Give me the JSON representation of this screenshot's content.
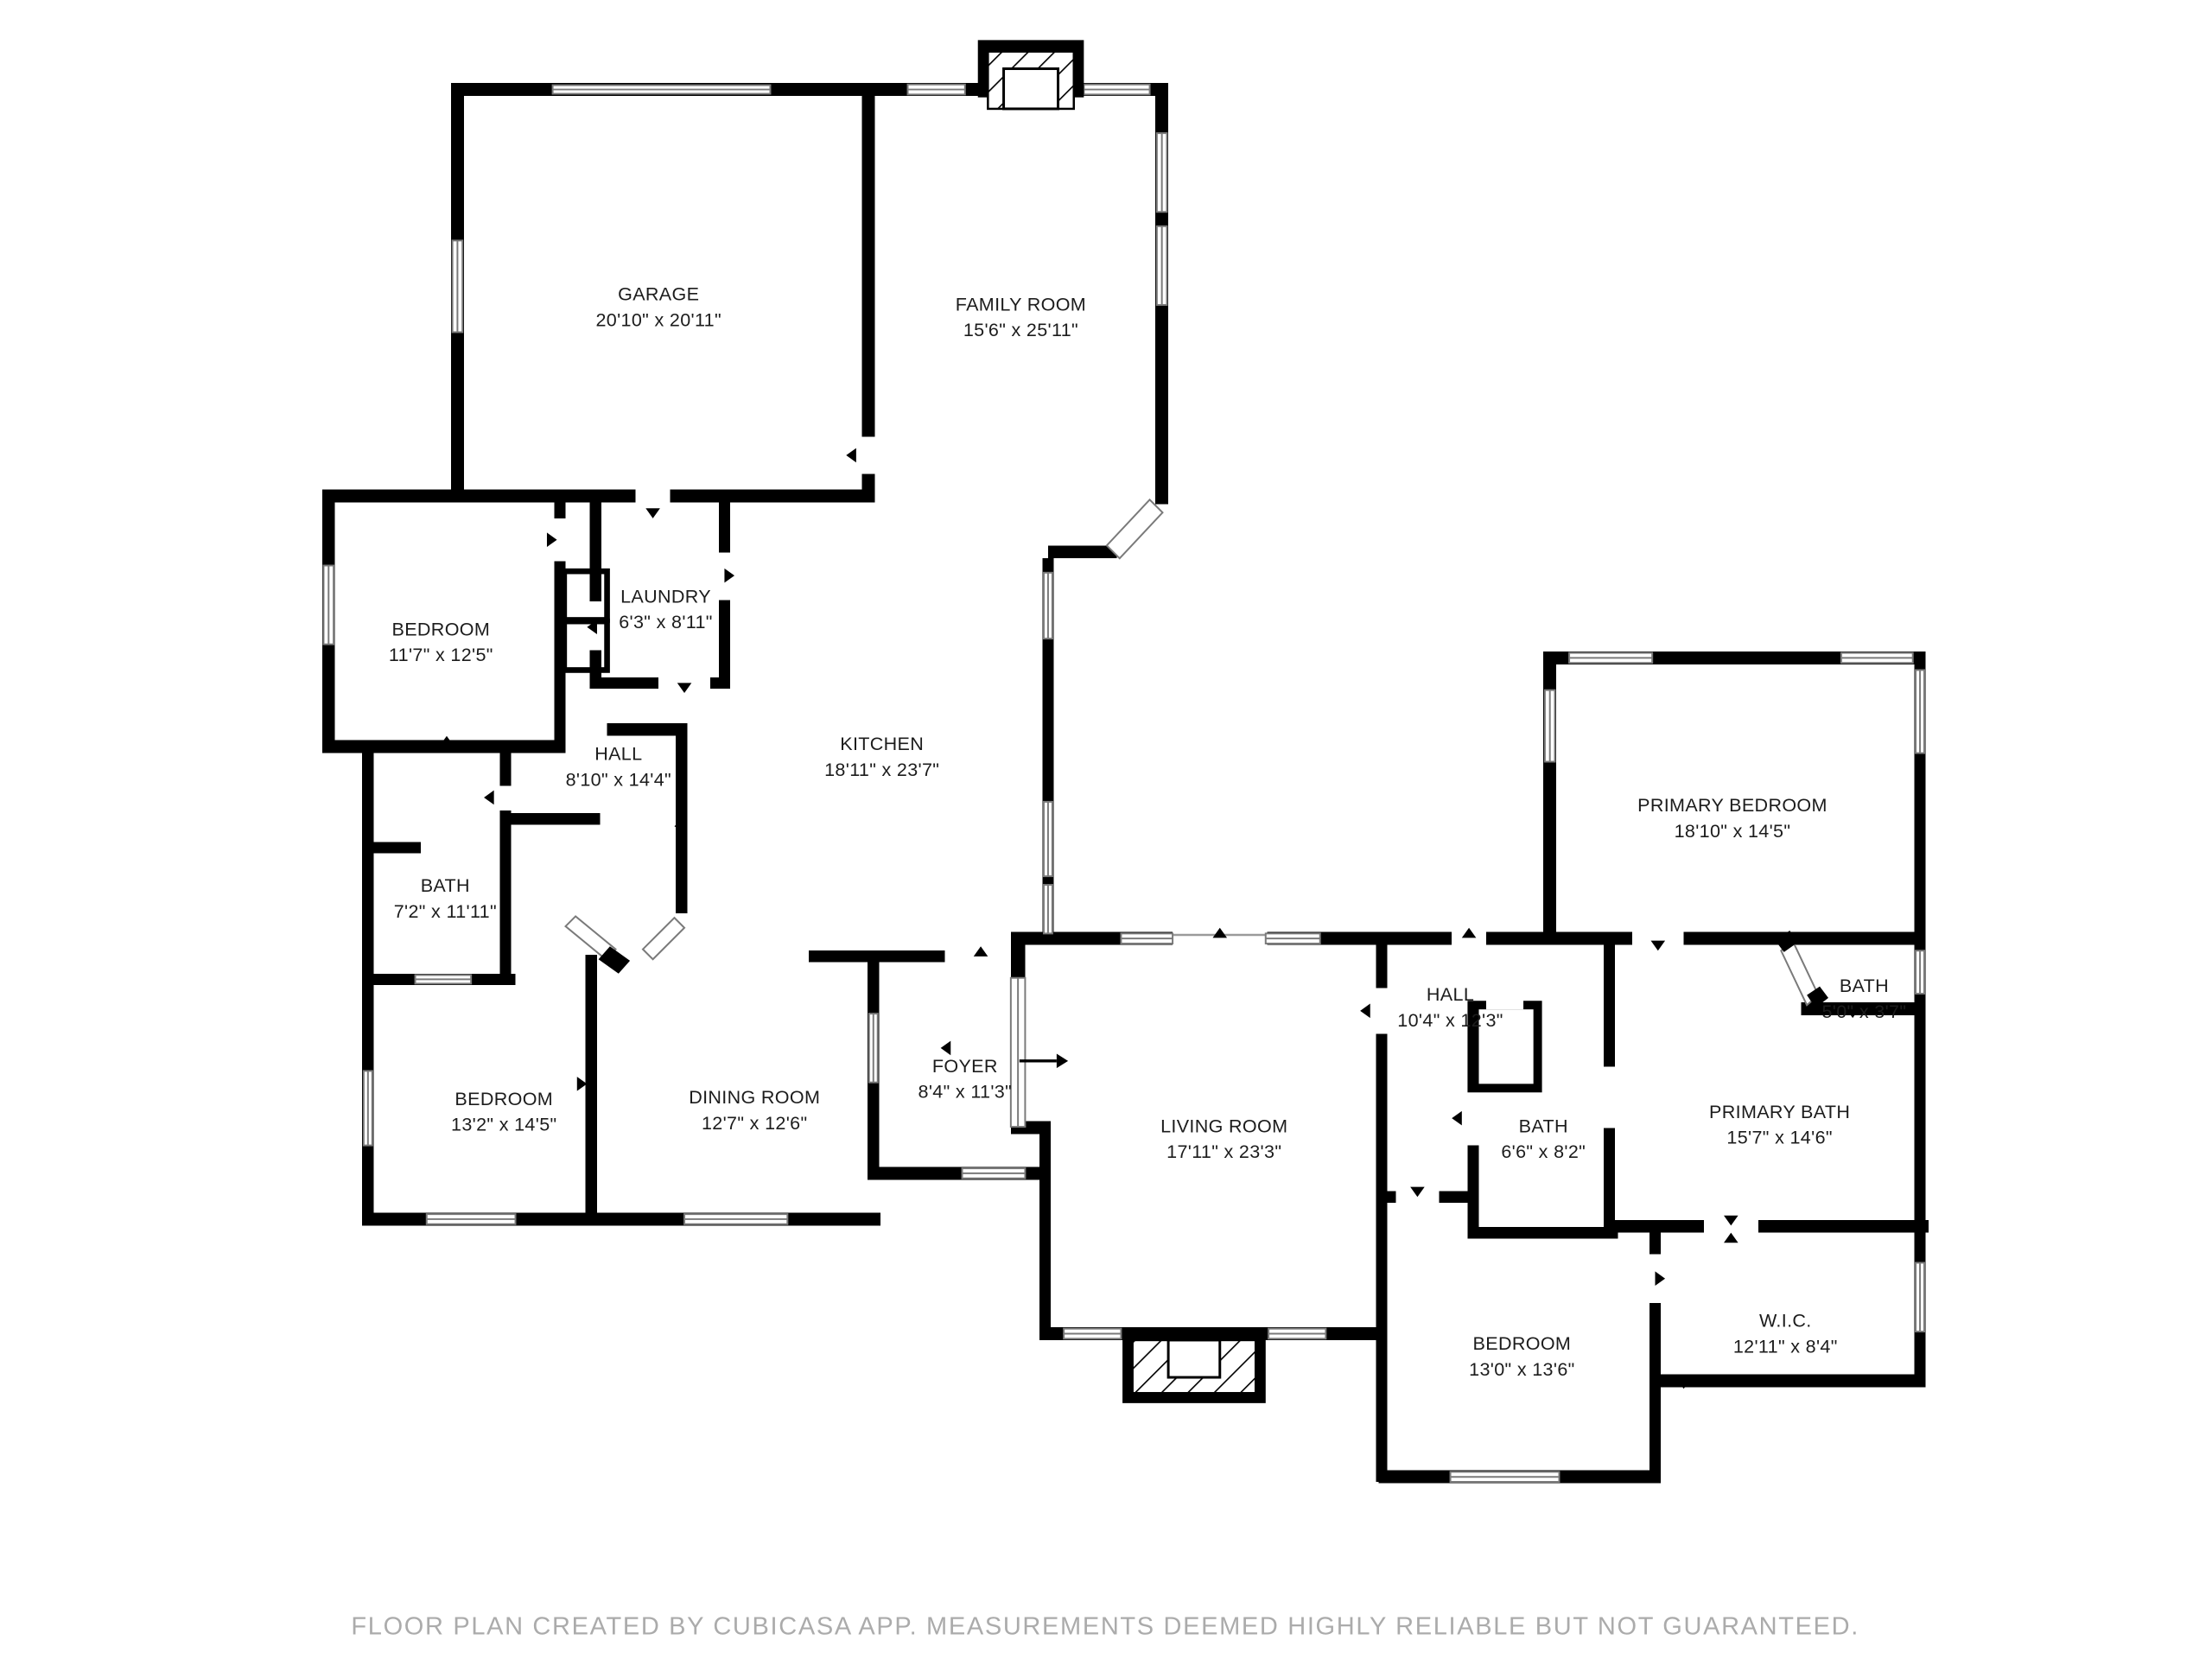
{
  "colors": {
    "wall": "#000000",
    "window_stroke": "#7a7a7a",
    "label_text": "#1c1c1c",
    "footer_text": "#ababab"
  },
  "rooms": {
    "garage": {
      "label": "GARAGE",
      "dims": "20'10\" x 20'11\""
    },
    "family_room": {
      "label": "FAMILY ROOM",
      "dims": "15'6\" x 25'11\""
    },
    "bedroom1": {
      "label": "BEDROOM",
      "dims": "11'7\" x 12'5\""
    },
    "laundry": {
      "label": "LAUNDRY",
      "dims": "6'3\" x 8'11\""
    },
    "hall1": {
      "label": "HALL",
      "dims": "8'10\" x 14'4\""
    },
    "kitchen": {
      "label": "KITCHEN",
      "dims": "18'11\" x 23'7\""
    },
    "bath1": {
      "label": "BATH",
      "dims": "7'2\" x 11'11\""
    },
    "bedroom2": {
      "label": "BEDROOM",
      "dims": "13'2\" x 14'5\""
    },
    "dining_room": {
      "label": "DINING ROOM",
      "dims": "12'7\" x 12'6\""
    },
    "foyer": {
      "label": "FOYER",
      "dims": "8'4\" x 11'3\""
    },
    "living_room": {
      "label": "LIVING ROOM",
      "dims": "17'11\" x 23'3\""
    },
    "hall2": {
      "label": "HALL",
      "dims": "10'4\" x 12'3\""
    },
    "bath2": {
      "label": "BATH",
      "dims": "6'6\" x 8'2\""
    },
    "primary_bedroom": {
      "label": "PRIMARY BEDROOM",
      "dims": "18'10\" x 14'5\""
    },
    "bath3": {
      "label": "BATH",
      "dims": "5'0\" x 3'7\""
    },
    "primary_bath": {
      "label": "PRIMARY BATH",
      "dims": "15'7\" x 14'6\""
    },
    "wic": {
      "label": "W.I.C.",
      "dims": "12'11\" x 8'4\""
    },
    "bedroom3": {
      "label": "BEDROOM",
      "dims": "13'0\" x 13'6\""
    }
  },
  "footer": {
    "disclaimer": "FLOOR PLAN CREATED BY CUBICASA APP. MEASUREMENTS DEEMED HIGHLY RELIABLE BUT NOT GUARANTEED."
  }
}
